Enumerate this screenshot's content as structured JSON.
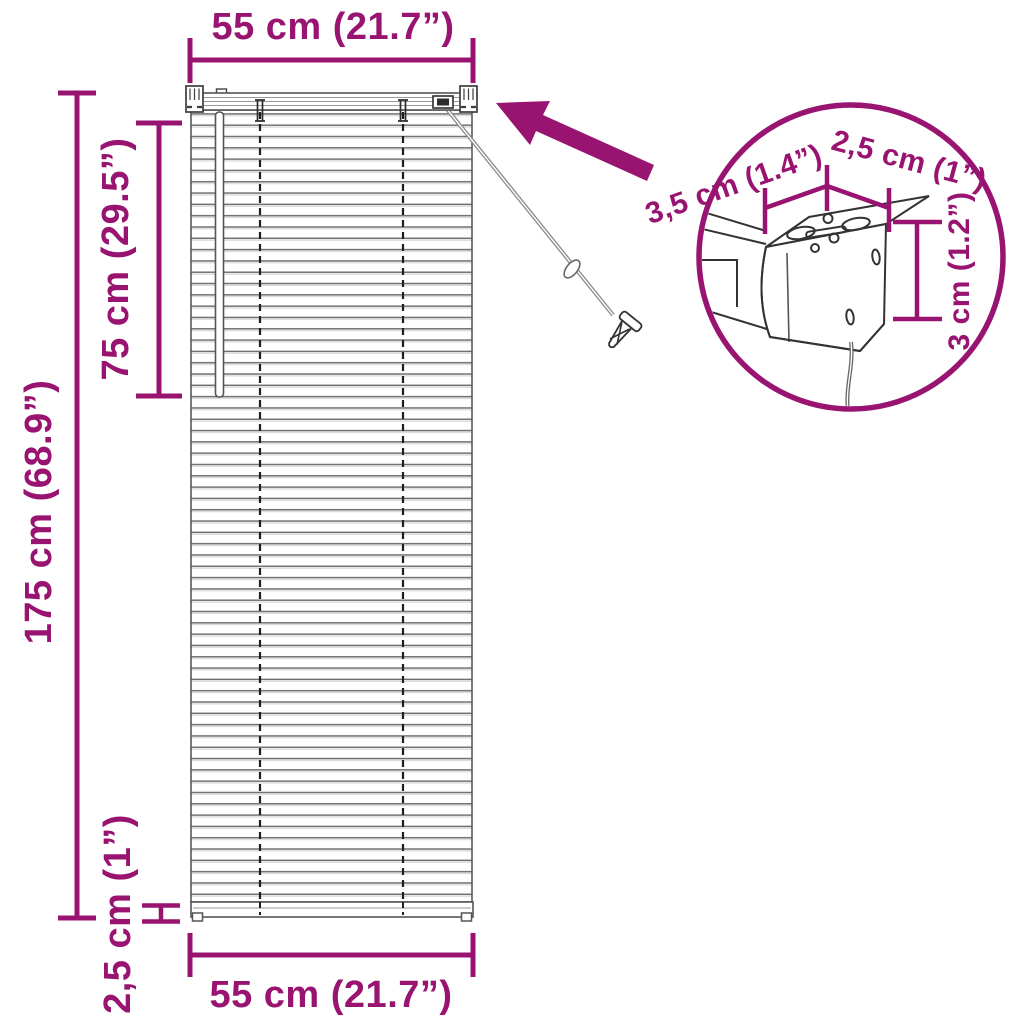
{
  "product": "venetian-blind-dimension-diagram",
  "accent_color": "#991471",
  "line_color": "#4d4d4d",
  "dimensions": {
    "top_width": "55 cm (21.7”)",
    "bottom_width": "55 cm (21.7”)",
    "total_height": "175 cm (68.9”)",
    "upper_section_height": "75 cm (29.5”)",
    "bottom_rail_height": "2,5 cm (1”)",
    "headrail_depth": "3,5 cm (1.4”)",
    "bracket_width": "2,5 cm (1”)",
    "headrail_height": "3 cm (1.2”)"
  }
}
